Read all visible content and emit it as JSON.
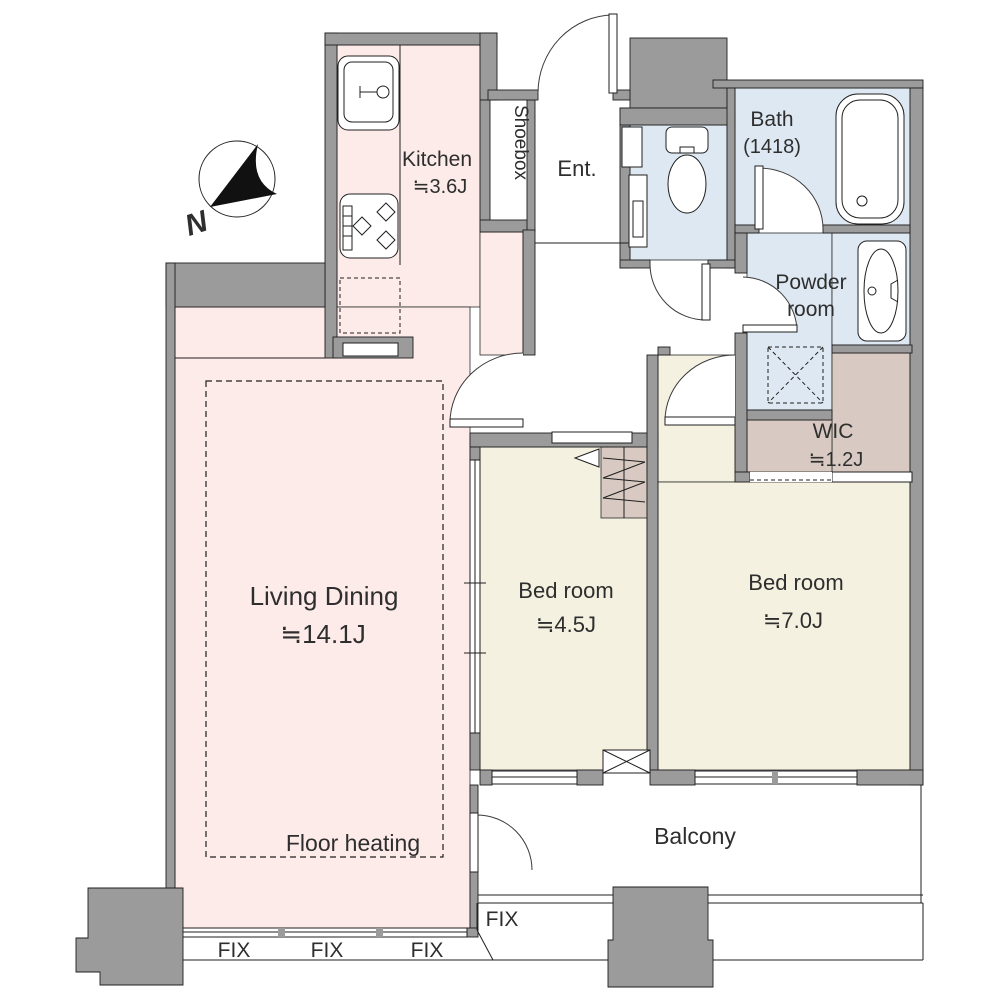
{
  "rooms": {
    "kitchen": {
      "name": "Kitchen",
      "area": "≒3.6J"
    },
    "shoebox": {
      "name": "Shoebox"
    },
    "entrance": {
      "name": "Ent."
    },
    "bath": {
      "name": "Bath",
      "area": "(1418)"
    },
    "powder": {
      "line1": "Powder",
      "line2": "room"
    },
    "wic": {
      "name": "WIC",
      "area": "≒1.2J"
    },
    "living": {
      "name": "Living Dining",
      "area": "≒14.1J",
      "floor_note": "Floor heating"
    },
    "bedroom_small": {
      "name": "Bed room",
      "area": "≒4.5J"
    },
    "bedroom_large": {
      "name": "Bed room",
      "area": "≒7.0J"
    },
    "balcony": {
      "name": "Balcony"
    }
  },
  "windows": {
    "fix": [
      "FIX",
      "FIX",
      "FIX",
      "FIX"
    ]
  },
  "compass": {
    "north": "N"
  },
  "colors": {
    "wall": "#9b9b9b",
    "floor_pink": "#fcebe9",
    "floor_cream": "#f4f1e1",
    "floor_wet": "#dee8f2",
    "floor_closet": "#d8cac2",
    "line": "#1f1f1f",
    "text": "#2e2e2e"
  }
}
